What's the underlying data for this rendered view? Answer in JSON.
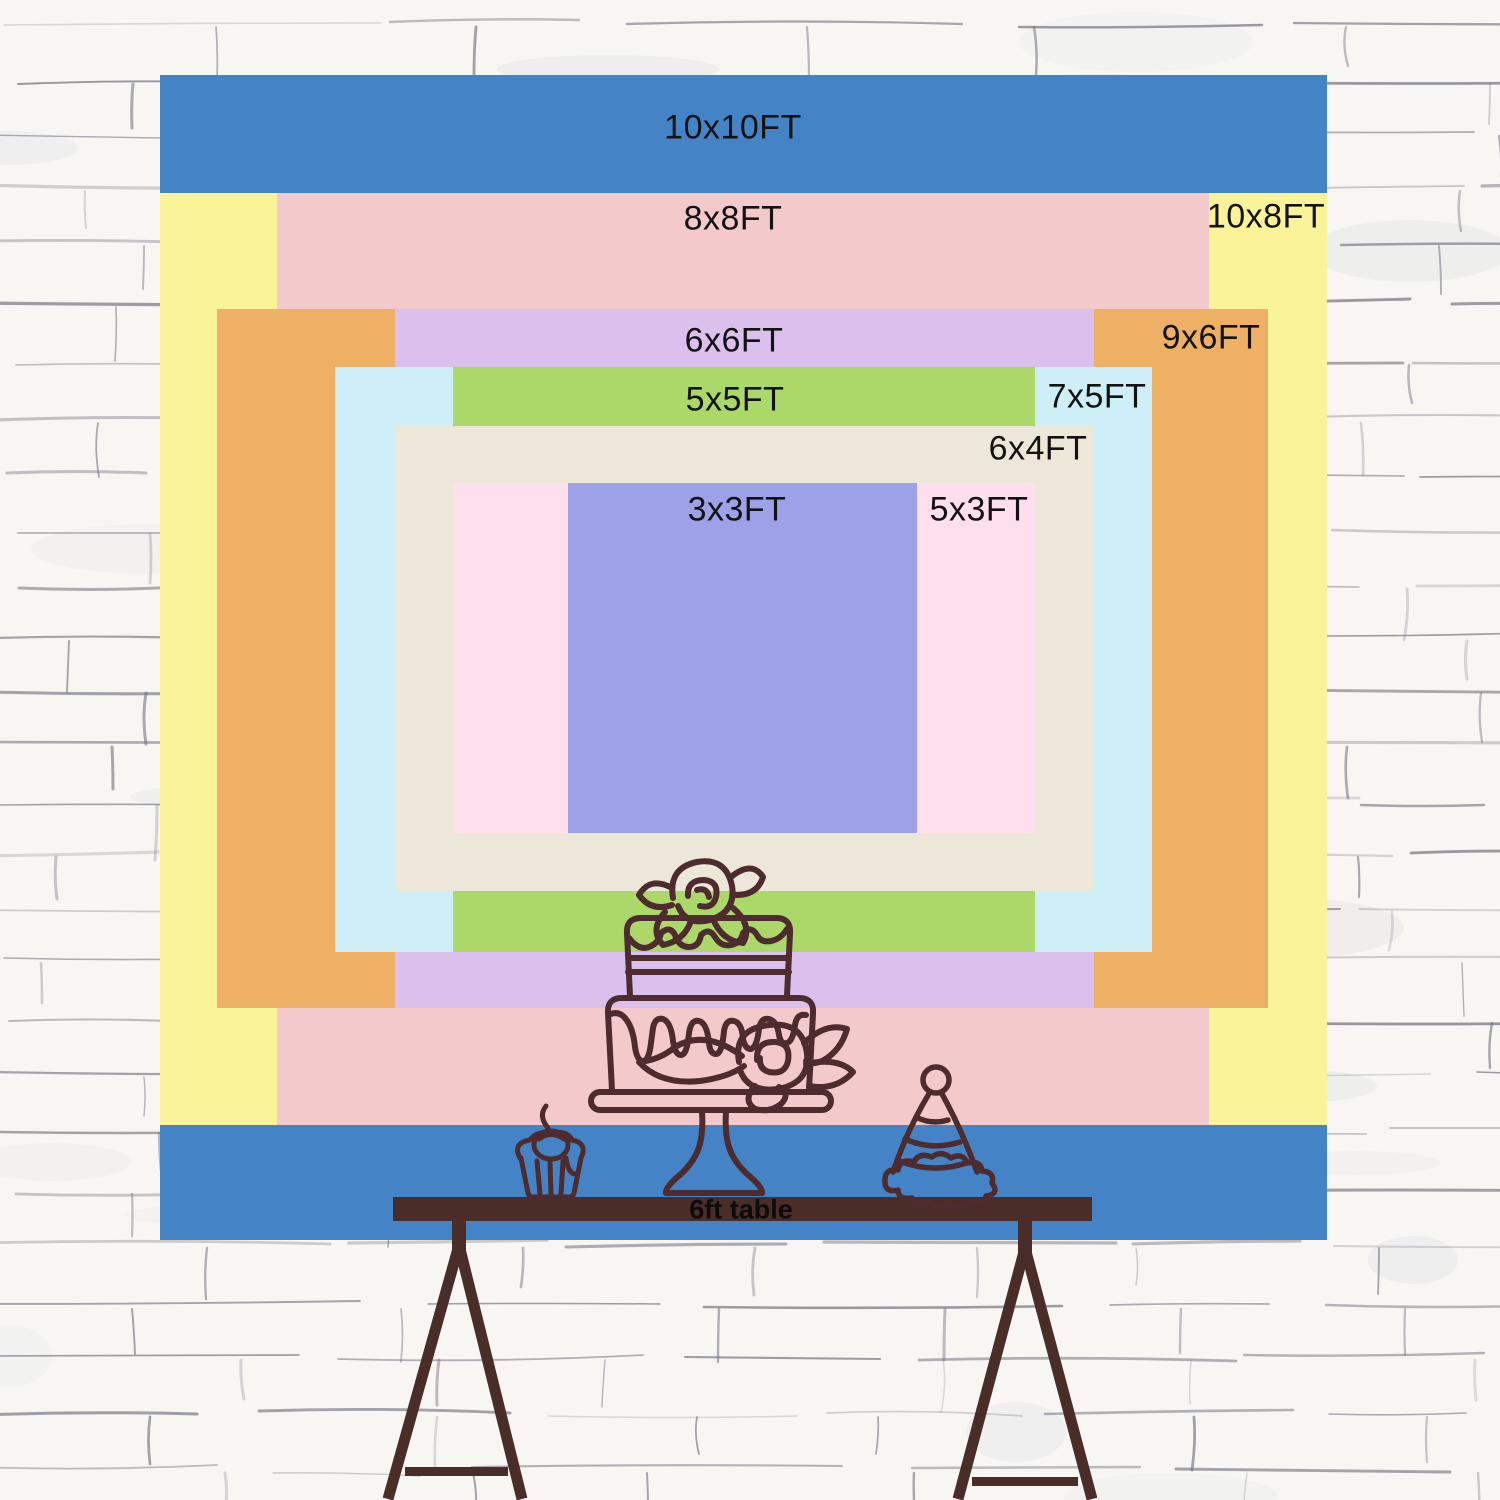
{
  "backdrop_layers": [
    {
      "size": "10x10FT",
      "color": "#4484c6",
      "x": 160,
      "y": 75,
      "w": 1167,
      "h": 1165,
      "label": {
        "x": 733,
        "y": 128
      }
    },
    {
      "size": "10x8FT",
      "color": "#faf397",
      "x": 160,
      "y": 193,
      "w": 1167,
      "h": 932,
      "label": {
        "x": 1266,
        "y": 217
      }
    },
    {
      "size": "8x8FT",
      "color": "#f4c9cb",
      "x": 277,
      "y": 193,
      "w": 932,
      "h": 932,
      "label": {
        "x": 733,
        "y": 219
      }
    },
    {
      "size": "9x6FT",
      "color": "#eeb064",
      "x": 217,
      "y": 309,
      "w": 1051,
      "h": 699,
      "label": {
        "x": 1211,
        "y": 338
      }
    },
    {
      "size": "6x6FT",
      "color": "#dbc0ee",
      "x": 395,
      "y": 309,
      "w": 699,
      "h": 699,
      "label": {
        "x": 734,
        "y": 341
      }
    },
    {
      "size": "7x5FT",
      "color": "#ceeef8",
      "x": 335,
      "y": 367,
      "w": 817,
      "h": 585,
      "label": {
        "x": 1097,
        "y": 397
      }
    },
    {
      "size": "5x5FT",
      "color": "#acd86a",
      "x": 453,
      "y": 367,
      "w": 582,
      "h": 585,
      "label": {
        "x": 735,
        "y": 400
      }
    },
    {
      "size": "6x4FT",
      "color": "#ece7d8",
      "x": 395,
      "y": 426,
      "w": 698,
      "h": 465,
      "label": {
        "x": 1038,
        "y": 449
      }
    },
    {
      "size": "5x3FT",
      "color": "#ffdfee",
      "x": 453,
      "y": 483,
      "w": 582,
      "h": 350,
      "label": {
        "x": 979,
        "y": 510
      }
    },
    {
      "size": "3x3FT",
      "color": "#9ea0e8",
      "x": 568,
      "y": 483,
      "w": 349,
      "h": 350,
      "label": {
        "x": 737,
        "y": 510
      }
    }
  ],
  "table": {
    "label": "6ft table"
  },
  "illustrations": [
    {
      "name": "birthday-cake-icon"
    },
    {
      "name": "cupcake-icon"
    },
    {
      "name": "party-hat-icon"
    },
    {
      "name": "trestle-table-icon"
    }
  ],
  "colors": {
    "outline_brown": "#4d2b2e",
    "table_brown": "#4a2c28",
    "label_text": "#131313",
    "wall_mortar": "#7d7c8a",
    "wall_base": "#f7f6f3"
  }
}
